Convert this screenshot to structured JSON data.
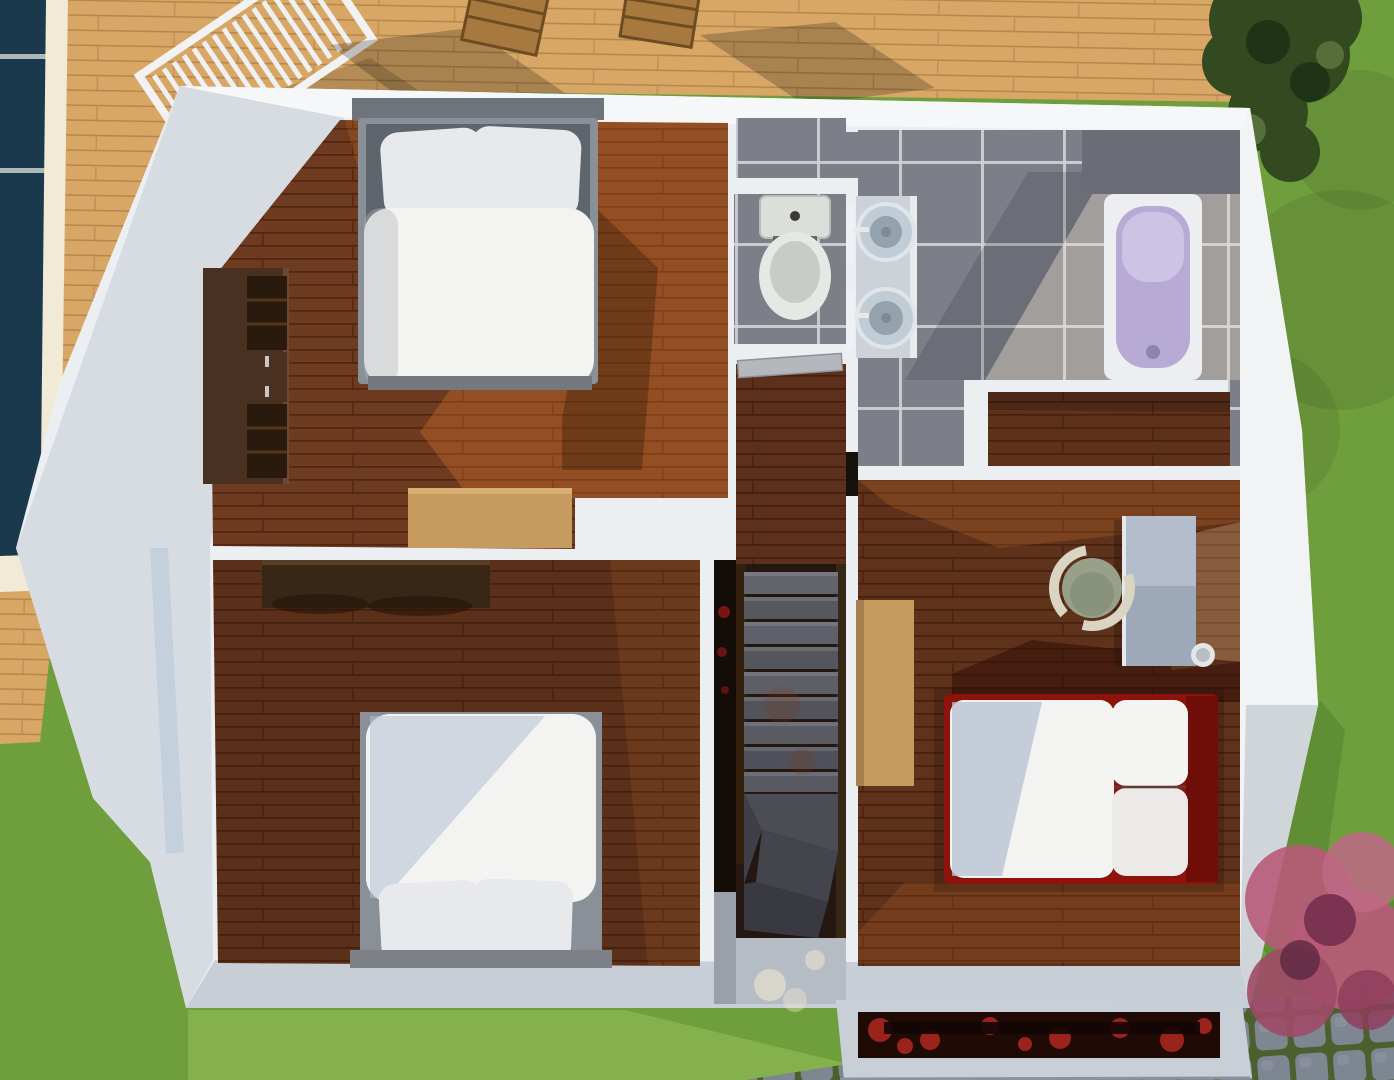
{
  "scene": {
    "kind": "3d-floor-plan-render",
    "view": "top-down cutaway of upper floor",
    "rooms": [
      {
        "id": "bedroom-1",
        "position": "top-left",
        "floor": "dark wood planks",
        "furniture": [
          "double-bed-white-duvet",
          "walnut-wardrobe",
          "tan-rug"
        ]
      },
      {
        "id": "bedroom-2",
        "position": "bottom-left",
        "floor": "dark wood planks",
        "furniture": [
          "double-bed-white-duvet",
          "walnut-dresser"
        ]
      },
      {
        "id": "wc",
        "position": "top-center",
        "floor": "grey tile",
        "furniture": [
          "toilet"
        ]
      },
      {
        "id": "bathroom",
        "position": "top-right",
        "floor": "grey tile",
        "furniture": [
          "vanity-two-round-sinks",
          "bathtub-lavender"
        ]
      },
      {
        "id": "hallway-stairs",
        "position": "center",
        "floor": "wood + dark stair carpet",
        "furniture": [
          "winder-staircase",
          "open-door"
        ]
      },
      {
        "id": "closet",
        "position": "right-middle",
        "floor": "dark wood planks",
        "furniture": []
      },
      {
        "id": "bedroom-3",
        "position": "right",
        "floor": "dark wood planks",
        "furniture": [
          "red-frame-bed-white-duvet",
          "desk",
          "sage-tub-chair",
          "tan-sideboard",
          "waste-bin"
        ]
      }
    ],
    "outdoor": [
      "pool",
      "wood-deck",
      "deck-loungers-and-chairs",
      "lawn",
      "hedge",
      "pink-shrub",
      "cobblestone-path",
      "red-flower-planter"
    ]
  },
  "colors": {
    "grass": "#6f9e3d",
    "grassLight": "#85b14c",
    "grassDark": "#4e7a2c",
    "deck": "#d8a766",
    "deckLine": "#b1834b",
    "pool": "#24455c",
    "poolEdge": "#f0ead6",
    "wall": "#eceff2",
    "wallShade": "#d6dce2",
    "wallBottom": "#c8ced6",
    "woodFloor": "#6e3a20",
    "woodFloorLine": "#4e2410",
    "sunlit": "#ff8a30",
    "tile": "#7d7f88",
    "tileGrout": "#d2d3d7",
    "tileDark": "#6b6d76",
    "stairTread": "#5e5e66",
    "stairDark": "#241610",
    "landing": "#b6bcc4",
    "duvet": "#f3f3f1",
    "duvetShadow": "#b5c0d1",
    "pillow": "#e8e9ec",
    "bedFrame": "#8a9098",
    "headboard": "#6e747b",
    "redBed": "#8e130c",
    "redBedDark": "#6f0e08",
    "walnut": "#4a3020",
    "walnutDark": "#382616",
    "tan": "#c79a5f",
    "deskTop": "#9da8b8",
    "chairSage": "#98a089",
    "chairRing": "#d9d5c2",
    "ceramic": "#e6e8e4",
    "tub": "#eceef2",
    "tubInner": "#b7abd6",
    "hedge": "#33491f",
    "shrub": "#b85a78",
    "cobble": "#7e8692",
    "moss": "#4c5f2e",
    "planterRed": "#b02820",
    "planterDark": "#200a06",
    "void": "#140c06"
  }
}
